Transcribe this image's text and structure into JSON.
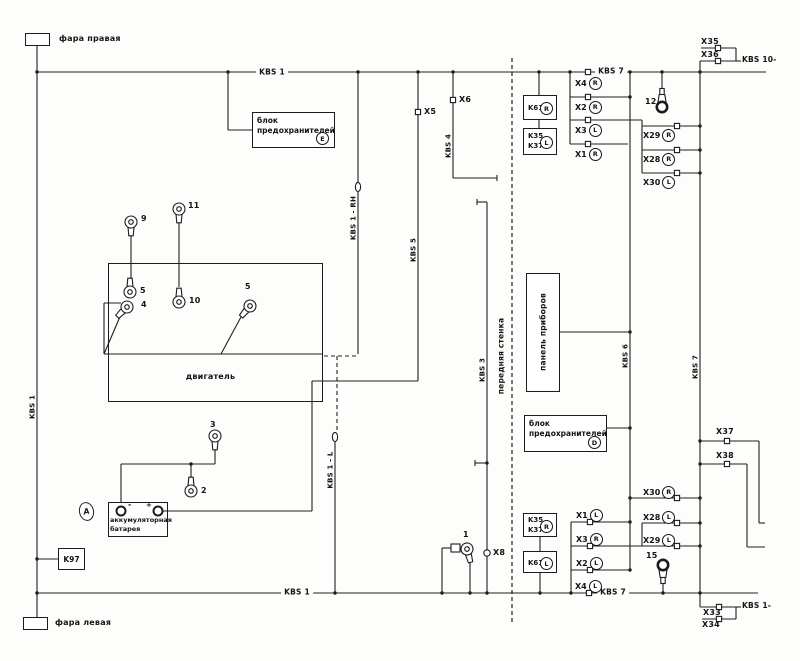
{
  "boxes": {
    "headlight_right": "фара правая",
    "headlight_left": "фара левая",
    "fuse_top": {
      "l1": "блок",
      "l2": "предохранителей",
      "badge": "E"
    },
    "fuse_mid": {
      "l1": "блок",
      "l2": "предохранителей",
      "badge": "D"
    },
    "engine": "двигатель",
    "battery": {
      "l1": "аккумуляторная",
      "l2": "батарея",
      "minus": "-",
      "plus": "+"
    },
    "panel": "панель приборов",
    "k97": "K97",
    "ground_badge": "A"
  },
  "wall_label": "передняя стенка",
  "wire_labels": {
    "kbs1_top": "KBS 1",
    "kbs1_bottom": "KBS 1",
    "kbs1_left": "KBS 1",
    "kbs3": "KBS 3",
    "kbs4": "KBS 4",
    "kbs5": "KBS 5",
    "kbs6": "KBS 6",
    "kbs7_top": "KBS 7",
    "kbs7_bottom": "KBS 7",
    "kbs7_right": "KBS 7",
    "kbs10": "KBS 10-",
    "kbs1_corner": "KBS 1-",
    "kbs1_rh": "KBS 1 - RH",
    "kbs1_lh": "KBS 1 - L"
  },
  "relays": {
    "top_k61": {
      "label": "K61",
      "side": "R"
    },
    "top_k3537": {
      "l1": "K35",
      "l2": "K37",
      "side": "L"
    },
    "bot_k3537": {
      "l1": "K35",
      "l2": "K37",
      "side": "R"
    },
    "bot_k61": {
      "label": "K61",
      "side": "L"
    }
  },
  "connectors": {
    "top_mid": [
      {
        "label": "X4",
        "side": "R"
      },
      {
        "label": "X2",
        "side": "R"
      },
      {
        "label": "X3",
        "side": "L"
      },
      {
        "label": "X1",
        "side": "R"
      }
    ],
    "top_right": [
      {
        "label": "X29",
        "side": "R"
      },
      {
        "label": "X28",
        "side": "R"
      },
      {
        "label": "X30",
        "side": "L"
      }
    ],
    "bot_mid": [
      {
        "label": "X1",
        "side": "L"
      },
      {
        "label": "X3",
        "side": "R"
      },
      {
        "label": "X2",
        "side": "L"
      },
      {
        "label": "X4",
        "side": "L"
      }
    ],
    "bot_right": [
      {
        "label": "X30",
        "side": "R"
      },
      {
        "label": "X28",
        "side": "L"
      },
      {
        "label": "X29",
        "side": "L"
      }
    ],
    "singles": {
      "x5": "X5",
      "x6": "X6",
      "x8": "X8",
      "x33": "X33",
      "x34": "X34",
      "x35": "X35",
      "x36": "X36",
      "x37": "X37",
      "x38": "X38"
    }
  },
  "terminals": {
    "t1": "1",
    "t2": "2",
    "t3": "3",
    "t4": "4",
    "t5a": "5",
    "t5b": "5",
    "t9": "9",
    "t10": "10",
    "t11": "11",
    "t12": "12",
    "t15": "15"
  }
}
